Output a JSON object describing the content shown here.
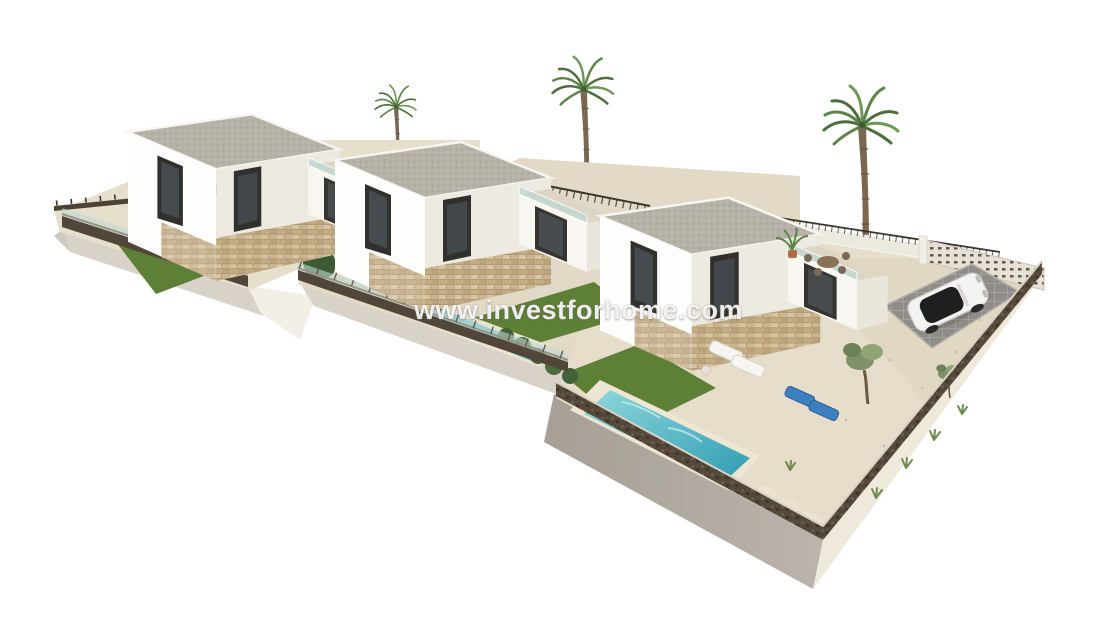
{
  "watermark": {
    "text": "www.investforhome.com"
  },
  "scene": {
    "type": "3d-architectural-render",
    "subject": "Aerial rendering of three modern white new-build villas on a staggered plot, each with private pool, lawn and terrace",
    "background": "#ffffff",
    "villas": [
      {
        "name": "villa-1",
        "position": "back-left",
        "features": [
          "two-story-white-cube",
          "gravel-flat-roof",
          "stone-clad-base",
          "glass-railing-roof-terrace",
          "lawn-with-boulders"
        ]
      },
      {
        "name": "villa-2",
        "position": "middle",
        "features": [
          "two-story-white-cube",
          "gravel-flat-roof",
          "stone-clad-base",
          "glass-railing-roof-terrace",
          "narrow-lap-pool",
          "lawn",
          "hedge-row"
        ]
      },
      {
        "name": "villa-3",
        "position": "front-right",
        "features": [
          "two-story-white-cube",
          "gravel-flat-roof",
          "stone-clad-base",
          "roof-terrace-with-dining-set",
          "large-pool",
          "lawn",
          "sun-loungers",
          "olive-trees",
          "gravel-garden",
          "parking-pad-with-car",
          "breeze-block-wall"
        ]
      }
    ],
    "objects": [
      "palm-tree x3",
      "terrace-potted-palm",
      "olive-tree x2",
      "white-suv-car",
      "sun-lounger-white x2",
      "sun-lounger-blue x2",
      "terrace-dining-set",
      "decorative-boulders",
      "perimeter-walls-with-glass-fence",
      "display-platform-base"
    ],
    "palette": {
      "background": "#ffffff",
      "pool": "#5bc4ce",
      "poolDeep": "#2f9cb2",
      "lawn": "#5d7f36",
      "pavement": "#e4dcc8",
      "stone": "#cbb491",
      "wallDark": "#52463a",
      "glass": "#bcd9d4",
      "platformCream": "#efe9dc",
      "platformShadow": "#b0aaa2",
      "apron": "#d8d2c8",
      "whiteWall": "#fdfdfb",
      "whiteWallShade": "#edeae2",
      "roofGravel": "#b7b2a8",
      "palmGreen": "#537743",
      "trunkBrown": "#7b6652",
      "loungerBlue": "#3e7fc1",
      "carWhite": "#f3f3f1"
    }
  }
}
